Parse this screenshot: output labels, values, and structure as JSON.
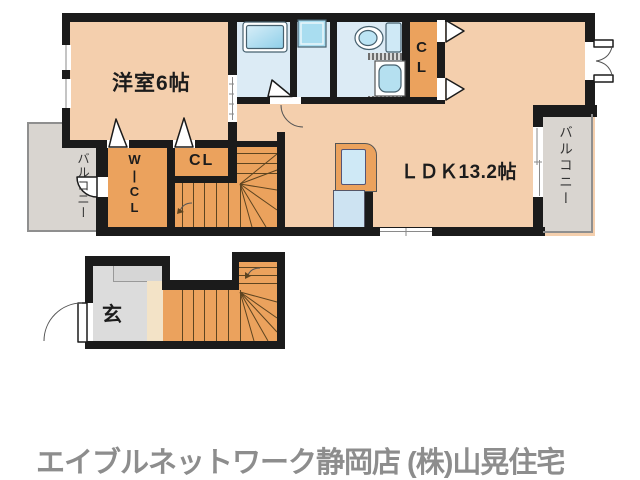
{
  "rooms": {
    "bedroom": "洋室6帖",
    "ldk": "ＬＤＫ13.2帖",
    "cl_upper": "CL",
    "cl_mid": "CL",
    "wicl": "W|CL",
    "balcony_left": "バルコニー",
    "balcony_right": "バルコニー",
    "entrance": "玄"
  },
  "icons": {
    "bathtub": "bathtub-icon",
    "washer_pan": "washing-machine-pan-icon",
    "toilet": "toilet-icon",
    "vanity": "wash-basin-icon",
    "kitchen_sink": "kitchen-sink-icon",
    "stairs": "staircase-icon",
    "doors": "door-swing-icon"
  },
  "footer": "エイブルネットワーク静岡店 (株)山晃住宅",
  "colors": {
    "wall": "#1b1b1b",
    "floor_main": "#f4cfad",
    "floor_closet": "#eba25d",
    "balcony": "#d9d5d0",
    "genkan": "#dcdcdc",
    "hall_wood": "#f3e3c7",
    "water_floor": "#dcebf5",
    "fixture_blue": "#a9ddf0",
    "stair_line": "#5d4420",
    "rail": "#8f8f8f",
    "logo_gray": "#8d8d8d"
  }
}
